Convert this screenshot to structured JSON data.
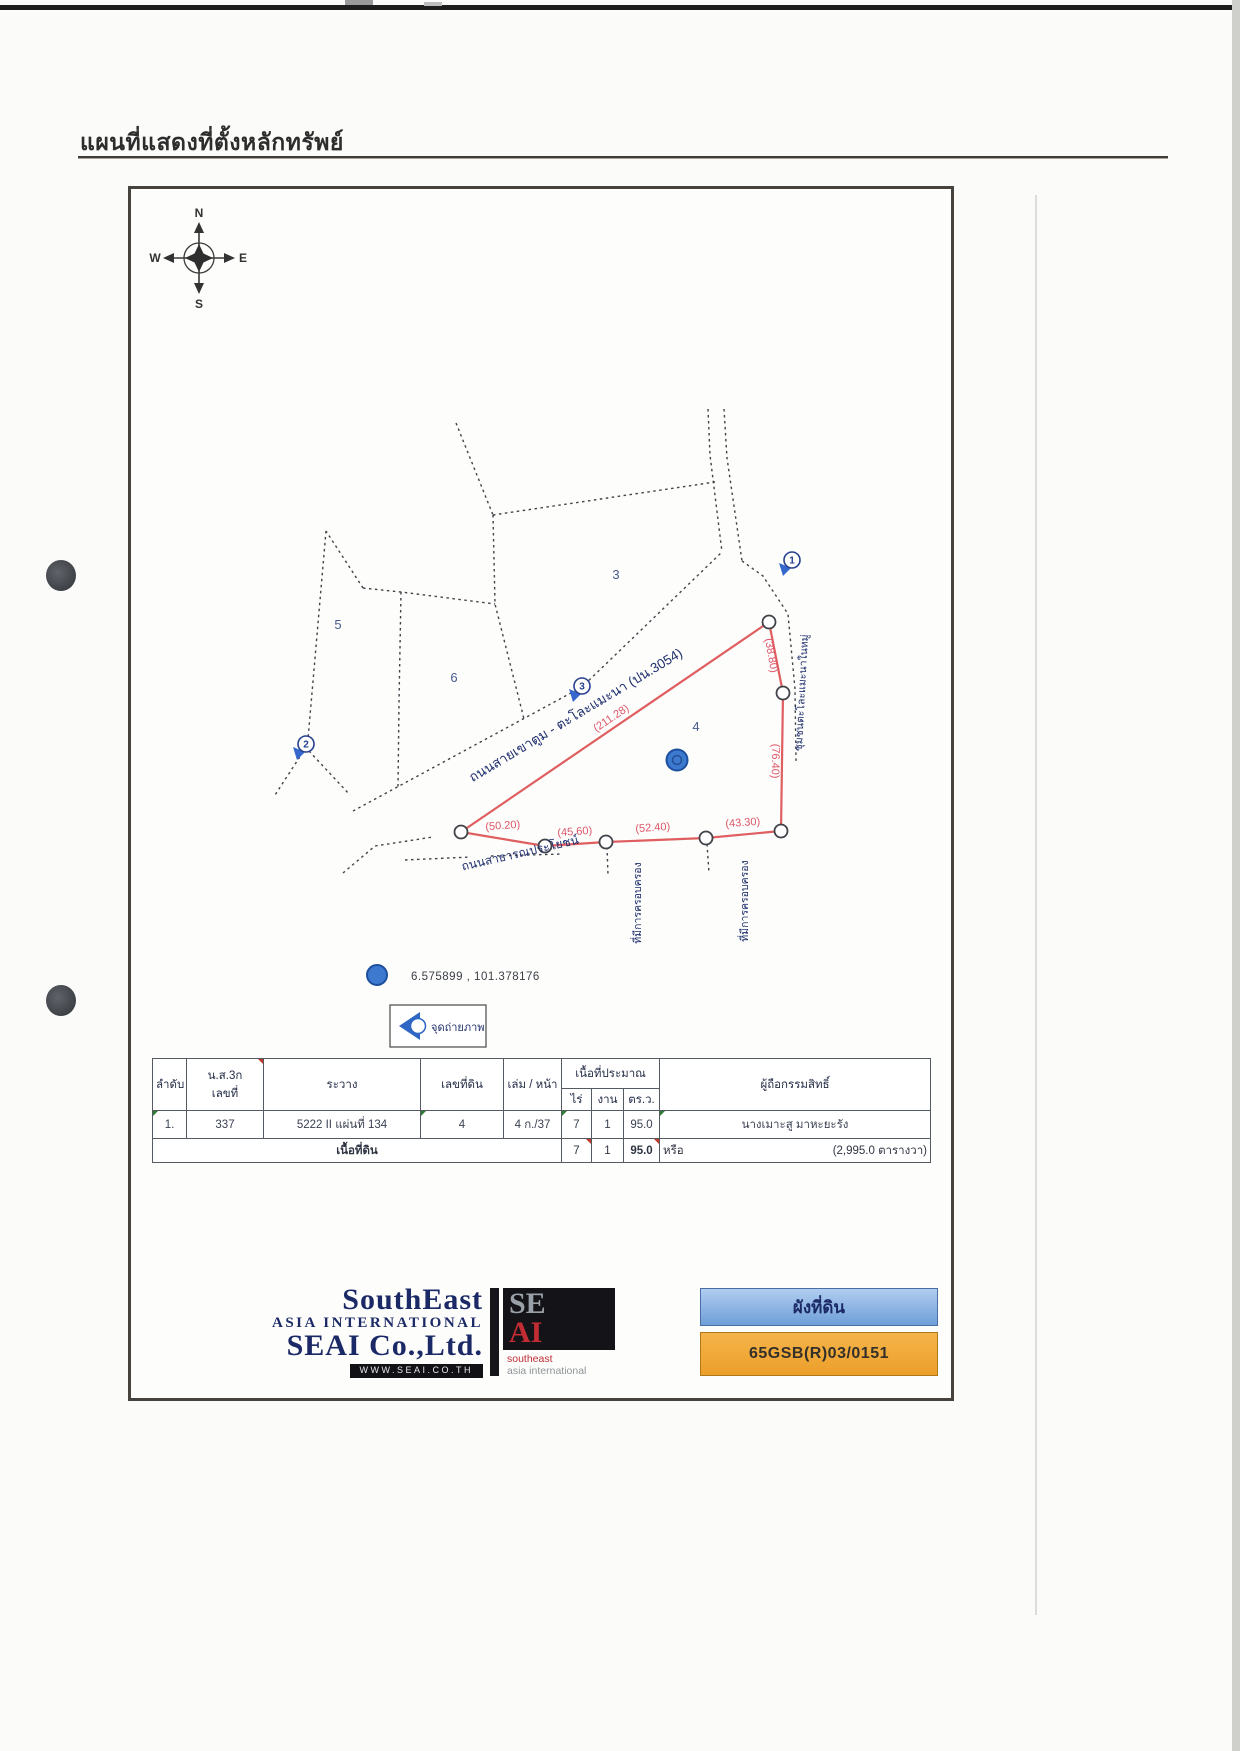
{
  "title": "แผนที่แสดงที่ตั้งหลักทรัพย์",
  "compass": {
    "north": "N",
    "south": "S",
    "east": "E",
    "west": "W"
  },
  "map": {
    "parcel_labels": {
      "p3": "3",
      "p4": "4",
      "p5": "5",
      "p6": "6"
    },
    "markers": {
      "m1": "1",
      "m2": "2",
      "m3": "3"
    },
    "main_road": "ถนนสายเขาตูม - ตะโละแมะนา (ปน.3054)",
    "public_road": "ถนนสาธารณประโยชน์",
    "community_road": "ชุมชนตะโละแมะนาในหมู่",
    "possession_left": "ที่มีการครอบครอง",
    "possession_right": "ที่มีการครอบครอง",
    "measurements": {
      "nw": "(211.28)",
      "ne": "(38.80)",
      "e": "(76.40)",
      "s1": "(50.20)",
      "s2": "(45.60)",
      "s3": "(52.40)",
      "s4": "(43.30)"
    },
    "coordinates": "6.575899 , 101.378176",
    "legend_photo_point": "จุดถ่ายภาพ"
  },
  "table": {
    "headers": {
      "seq": "ลำดับ",
      "deed_line1": "น.ส.3ก",
      "deed_line2": "เลขที่",
      "sheet": "ระวาง",
      "parcel_no": "เลขที่ดิน",
      "book_page": "เล่ม / หน้า",
      "area_group": "เนื้อที่ประมาณ",
      "rai": "ไร่",
      "ngan": "งาน",
      "sq_wa": "ตร.ว.",
      "owner": "ผู้ถือกรรมสิทธิ์"
    },
    "row": {
      "seq": "1.",
      "deed_no": "337",
      "sheet": "5222 II แผ่นที่ 134",
      "parcel_no": "4",
      "book_page": "4 ก./37",
      "rai": "7",
      "ngan": "1",
      "sq_wa": "95.0",
      "owner": "นางเมาะสู มาหะยะรัง"
    },
    "total": {
      "label": "เนื้อที่ดิน",
      "rai": "7",
      "ngan": "1",
      "sq_wa": "95.0",
      "or_label": "หรือ",
      "total_sq_wa": "(2,995.0  ตารางวา)"
    }
  },
  "footer": {
    "company_name_top": "SouthEast",
    "company_name_mid": "ASIA INTERNATIONAL",
    "company_name_bottom": "SEAI Co.,Ltd.",
    "website": "WWW.SEAI.CO.TH",
    "logo_se": "SE",
    "logo_ai": "AI",
    "logo_sub1": "southeast",
    "logo_sub2": "asia international",
    "doc_type": "ผังที่ดิน",
    "doc_number": "65GSB(R)03/0151"
  },
  "colors": {
    "survey_red": "#df5e60",
    "label_navy": "#1f2f6d",
    "marker_blue": "#3667cc",
    "doc_type_bg": "#8fb5e4",
    "doc_number_bg": "#f0a93c"
  }
}
